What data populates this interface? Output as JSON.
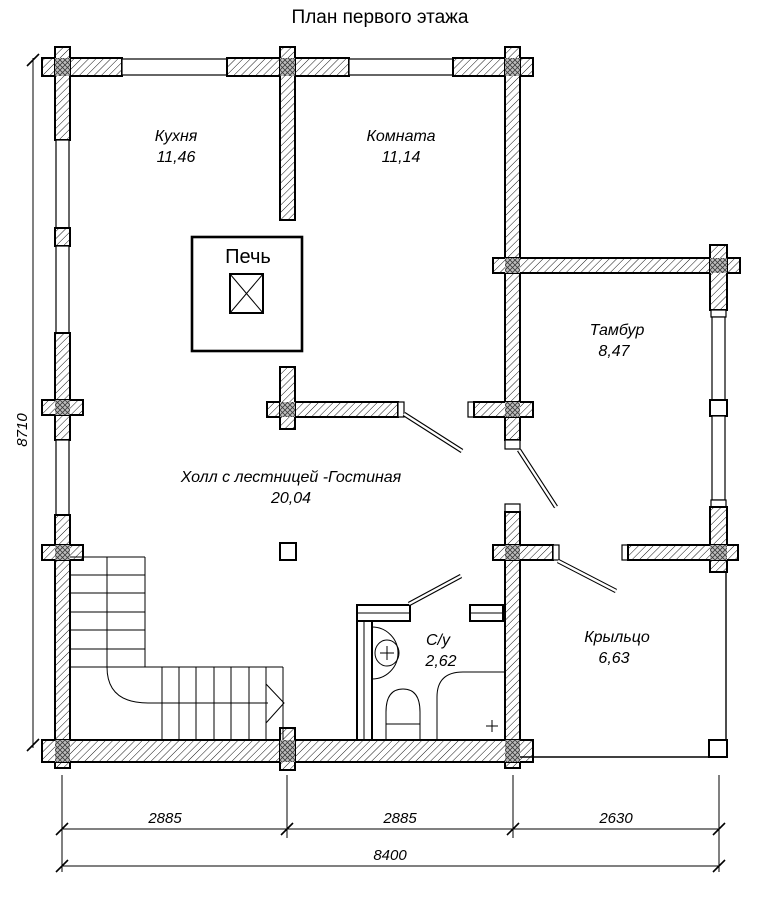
{
  "title": "План первого этажа",
  "stove": {
    "label": "Печь"
  },
  "rooms": {
    "kitchen": {
      "name": "Кухня",
      "area": "11,46"
    },
    "room": {
      "name": "Комната",
      "area": "11,14"
    },
    "tambour": {
      "name": "Тамбур",
      "area": "8,47"
    },
    "hall": {
      "name": "Холл с лестницей -Гостиная",
      "area": "20,04"
    },
    "wc": {
      "name": "С/у",
      "area": "2,62"
    },
    "porch": {
      "name": "Крыльцо",
      "area": "6,63"
    }
  },
  "dimensions": {
    "left_height": "8710",
    "bottom_segments": [
      "2885",
      "2885",
      "2630"
    ],
    "bottom_total": "8400"
  },
  "colors": {
    "ink": "#000000",
    "paper": "#ffffff"
  }
}
